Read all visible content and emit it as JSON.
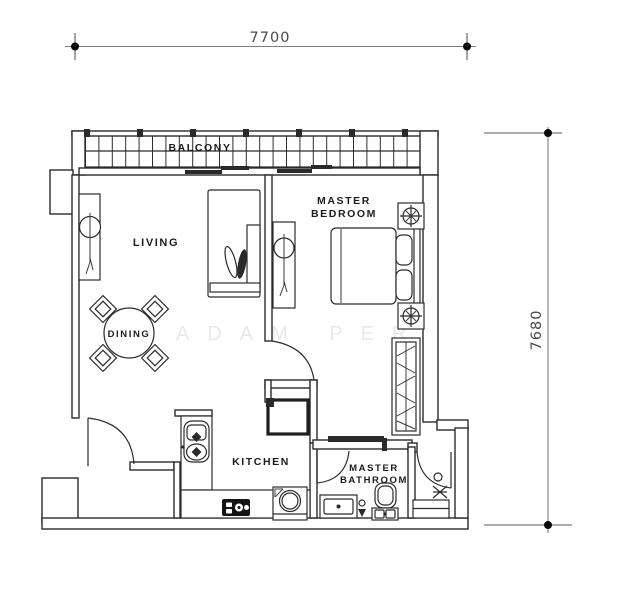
{
  "dimensions": {
    "top": "7700",
    "right": "7680"
  },
  "rooms": {
    "balcony": "BALCONY",
    "living": "LIVING",
    "dining": "DINING",
    "bedroom_l1": "MASTER",
    "bedroom_l2": "BEDROOM",
    "kitchen": "KITCHEN",
    "bathroom_l1": "MASTER",
    "bathroom_l2": "BATHROOM"
  },
  "watermark": "ADAM PERN",
  "colors": {
    "wall_line": "#2b2b2b",
    "dimension_line": "#7d7d7d",
    "dimension_text": "#4a4a4a",
    "label_text": "#1c1c1c",
    "watermark_text": "#e8e8e8",
    "background": "#ffffff",
    "fixture_dark": "#1a1a1a"
  }
}
